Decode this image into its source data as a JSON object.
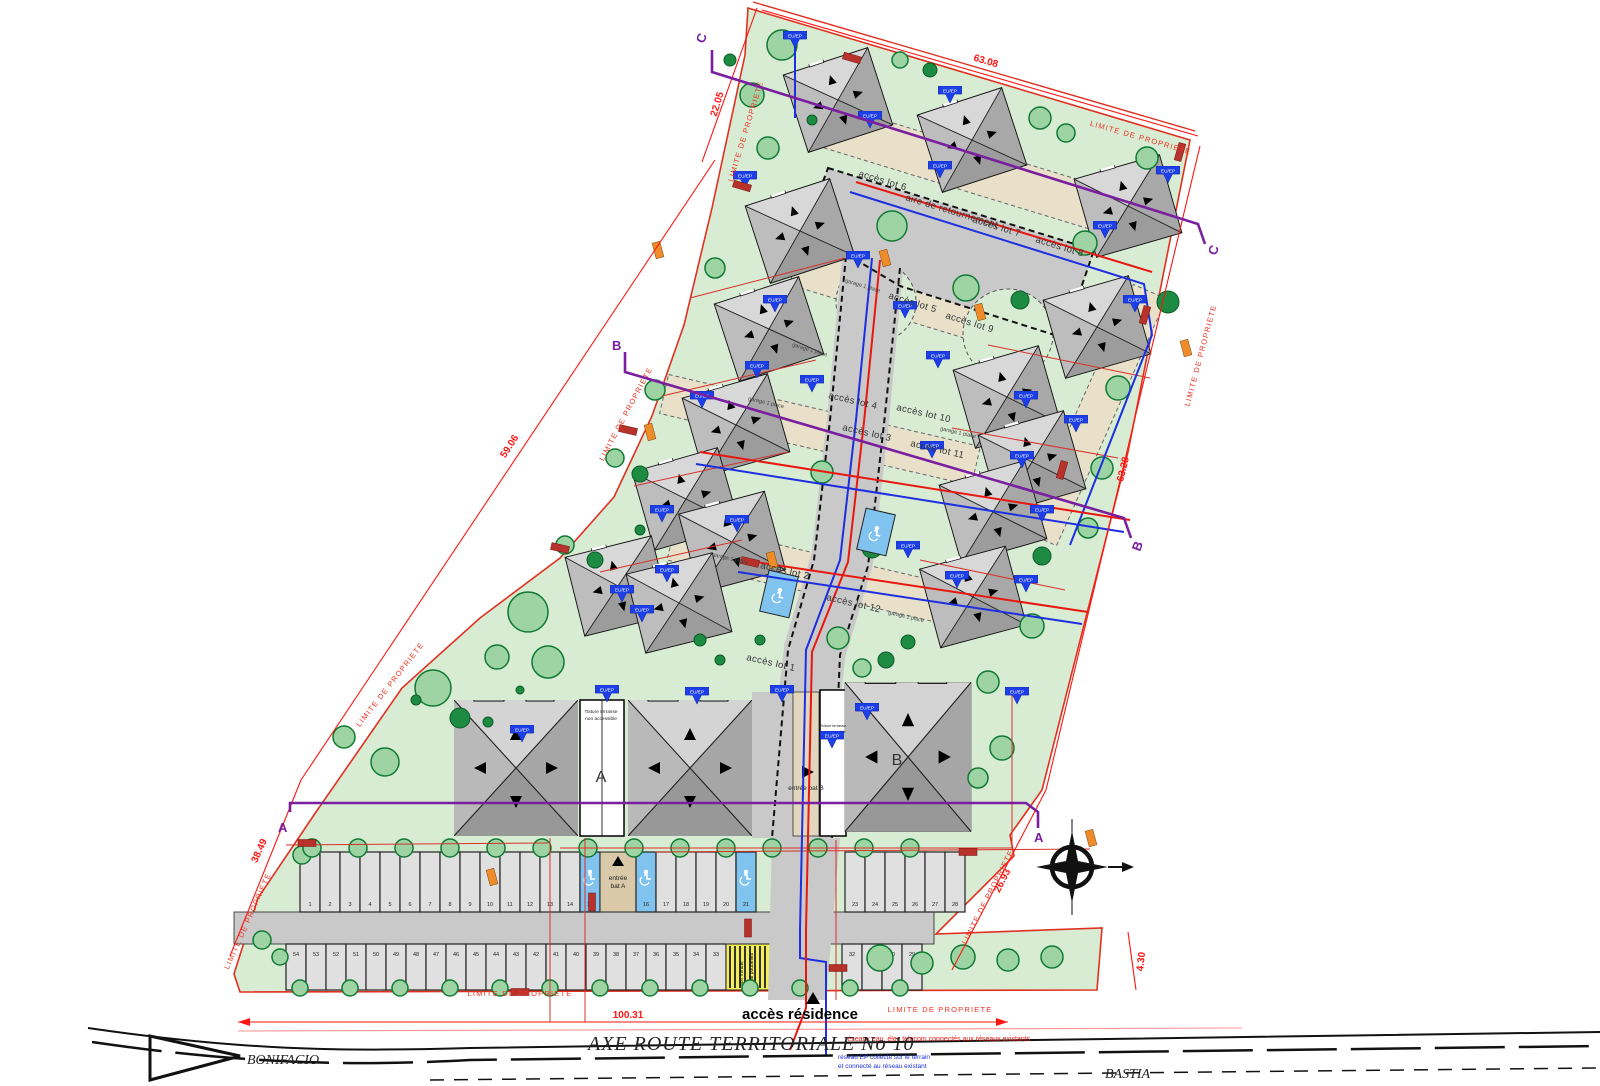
{
  "plan": {
    "boundary_label": "LIMITE DE PROPRIETE",
    "dimensions": {
      "top_left": "22.05",
      "top": "63.08",
      "left": "59.06",
      "right": "63.28",
      "bottom_left": "38.49",
      "bottom": "100.31",
      "bottom_right": "26.93",
      "strip": "4.30"
    },
    "sections": {
      "a": "A",
      "b": "B",
      "c": "C"
    },
    "streets": {
      "turnaround": "aire de retournement",
      "garage": "garage 1 place",
      "access_residence": "accès résidence"
    },
    "lots": [
      "accès lot 1",
      "accès lot 2",
      "accès lot 3",
      "accès lot 4",
      "accès lot 5",
      "accès lot 6",
      "accès lot 7",
      "accès lot 8",
      "accès lot 9",
      "accès lot 10",
      "accès lot 11",
      "accès lot 12"
    ],
    "buildings": {
      "a": "A",
      "b": "B",
      "entrance_a": "entrée bat A",
      "entrance_b": "entrée bat B",
      "roof_note_1": "Toiture terrasse",
      "roof_note_2": "non accessible"
    },
    "notes": {
      "red": "réseaux eau, élec telecom connectés aux réseaux existants",
      "blue_1": "réseau EP collecté sur le terrain",
      "blue_2": "et connecté au réseau existant"
    },
    "bins_1": "abri minute",
    "bins_2": "local poubelles",
    "roads": {
      "axis": "AXE ROUTE  TERRITORIALE  No 10",
      "left_city": "BONIFACIO",
      "right_city": "BASTIA"
    },
    "utility_flag": "EU/EP",
    "parking": {
      "top_row": [
        {
          "n": "1"
        },
        {
          "n": "2"
        },
        {
          "n": "3"
        },
        {
          "n": "4"
        },
        {
          "n": "5"
        },
        {
          "n": "6"
        },
        {
          "n": "7"
        },
        {
          "n": "8"
        },
        {
          "n": "9"
        },
        {
          "n": "10"
        },
        {
          "n": "11"
        },
        {
          "n": "12"
        },
        {
          "n": "13"
        },
        {
          "n": "14"
        },
        {
          "n": "15",
          "hc": true
        },
        {
          "gap": 36,
          "label": "entrée bat A"
        },
        {
          "n": "16",
          "hc": true
        },
        {
          "n": "17"
        },
        {
          "n": "18"
        },
        {
          "n": "19"
        },
        {
          "n": "20"
        },
        {
          "n": "21",
          "hc": true
        },
        {
          "gap": 89
        },
        {
          "n": "23"
        },
        {
          "n": "24"
        },
        {
          "n": "25"
        },
        {
          "n": "26"
        },
        {
          "n": "27"
        },
        {
          "n": "28"
        }
      ],
      "bottom_row": [
        {
          "n": "54"
        },
        {
          "n": "53"
        },
        {
          "n": "52"
        },
        {
          "n": "51"
        },
        {
          "n": "50"
        },
        {
          "n": "49"
        },
        {
          "n": "48"
        },
        {
          "n": "47"
        },
        {
          "n": "46"
        },
        {
          "n": "45"
        },
        {
          "n": "44"
        },
        {
          "n": "43"
        },
        {
          "n": "42"
        },
        {
          "n": "41"
        },
        {
          "n": "40"
        },
        {
          "n": "39"
        },
        {
          "n": "38"
        },
        {
          "n": "37"
        },
        {
          "n": "36"
        },
        {
          "n": "35"
        },
        {
          "n": "34"
        },
        {
          "n": "33"
        },
        {
          "bins": 46
        },
        {
          "gap": 70
        },
        {
          "n": "32"
        },
        {
          "n": "31"
        },
        {
          "n": "30"
        },
        {
          "n": "29"
        }
      ]
    }
  }
}
